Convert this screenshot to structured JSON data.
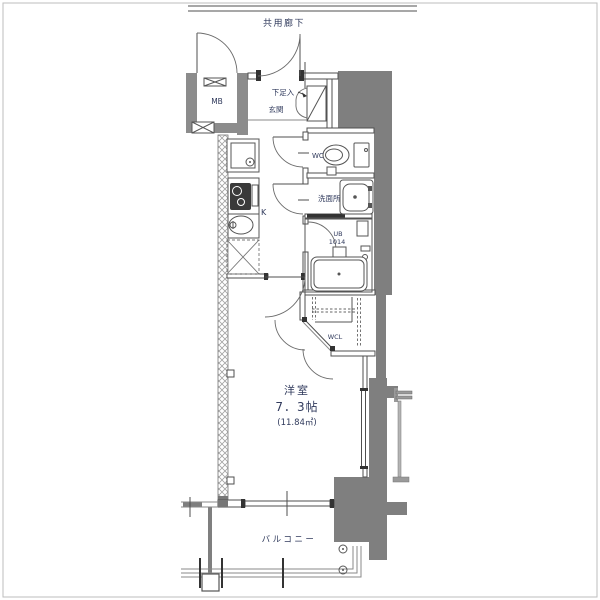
{
  "document": {
    "kind": "apartment-floor-plan",
    "orientation": "vertical-1K-unit"
  },
  "labels": {
    "common_corridor": "共用廊下",
    "meter_box": "MB",
    "shoe_cabinet": "下足入",
    "entrance": "玄関",
    "toilet": "WC",
    "washroom": "洗面所",
    "unit_bath": "UB",
    "unit_bath_size": "1014",
    "kitchen": "K",
    "walk_in_closet": "WCL",
    "main_room_type": "洋室",
    "main_room_size": "7．3帖",
    "main_room_area": "(11.84㎡)",
    "balcony": "バルコニー"
  },
  "colors": {
    "background": "#ffffff",
    "structure_gray": "#7f7f7f",
    "meter_box_wall_gray": "#8c8c8c",
    "line": "#4f4f4f",
    "label_text": "#303a5c",
    "hatch": "#a3a3a3",
    "frame_border": "#bdbdbd"
  }
}
